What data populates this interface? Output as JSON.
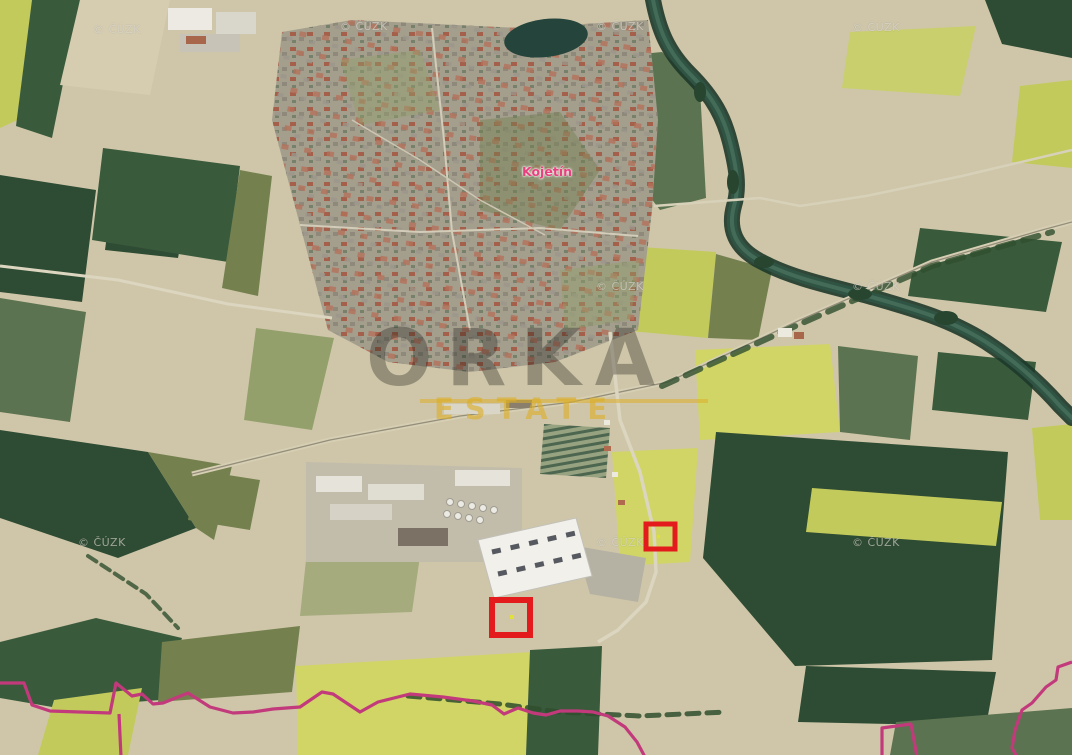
{
  "map": {
    "width": 1072,
    "height": 755,
    "town_label": {
      "text": "Kojetín",
      "color": "#e8407f",
      "x": 522,
      "y": 164
    },
    "copyright": {
      "text": "© ČÚZK",
      "color": "rgba(236,233,224,0.58)",
      "positions": [
        {
          "x": 93,
          "y": 23
        },
        {
          "x": 340,
          "y": 20
        },
        {
          "x": 596,
          "y": 20
        },
        {
          "x": 852,
          "y": 21
        },
        {
          "x": 596,
          "y": 280
        },
        {
          "x": 852,
          "y": 280
        },
        {
          "x": 78,
          "y": 536
        },
        {
          "x": 596,
          "y": 536
        },
        {
          "x": 852,
          "y": 536
        }
      ]
    },
    "brand_watermark": {
      "name": "ORKA",
      "sub": "ESTATE",
      "text_color": "rgba(25,24,22,0.32)",
      "accent_color": "rgba(220,174,40,0.62)",
      "line_color": "rgba(220,174,40,0.55)"
    },
    "boundary": {
      "color": "#c23a7b",
      "stroke_width": 3.2,
      "paths": [
        "0,683 24,683 32,705 50,711 110,713 116,683 132,696 142,694 153,704 163,703 188,693 210,707 233,713 253,712 273,709 300,707 322,692 333,694 360,712 378,702 410,694 443,697 473,701 492,705 504,714 518,708 533,713 546,715 560,711 578,711 593,712 608,716 625,727 637,742 645,757",
        "119,714 121,757",
        "882,757 882,728 911,724 917,757",
        "1072,662 1058,667 1056,680 1046,687 1032,703 1022,710 1015,730 1012,748 1017,757"
      ]
    },
    "markers": {
      "color": "#e41b1d",
      "dot_color": "#e3df3a",
      "rects": [
        {
          "x": 646,
          "y": 524,
          "w": 29,
          "h": 25,
          "stroke_width": 5,
          "dot": {
            "x": 657,
            "y": 535,
            "s": 3
          }
        },
        {
          "x": 492,
          "y": 600,
          "w": 38,
          "h": 35,
          "stroke_width": 6,
          "dot": {
            "x": 510,
            "y": 615,
            "s": 4
          }
        }
      ]
    },
    "terrain_palette": {
      "base_tan": "#cfc6a9",
      "field_dark_green": "#2e4b33",
      "field_green": "#5b7350",
      "field_olive": "#74814f",
      "rapeseed_yellow": "#d0d566",
      "yellow_green": "#c3ca5c",
      "water_trees": "#25443b",
      "town_gray": "#a49e8d"
    }
  }
}
